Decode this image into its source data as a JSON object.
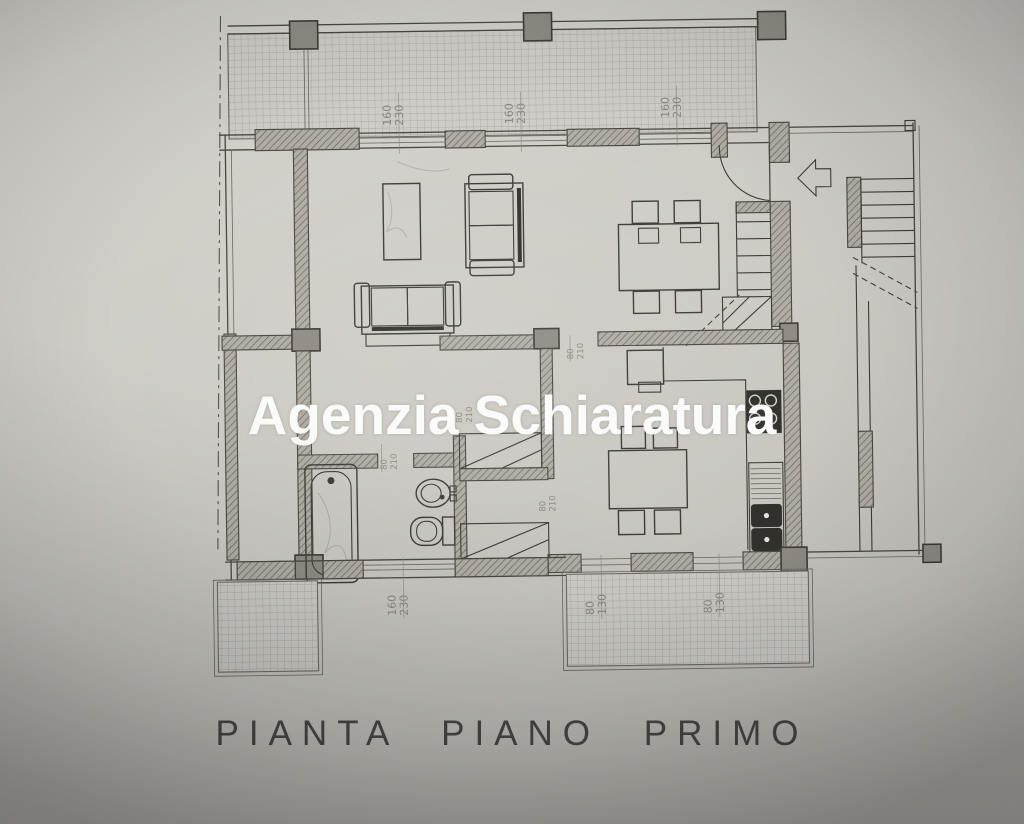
{
  "photo": {
    "watermark": "Agenzia Schiaratura",
    "caption": "PIANTA PIANO PRIMO"
  },
  "dimensions": {
    "window_large": {
      "width": "160",
      "height": "230"
    },
    "window_small": {
      "width": "80",
      "height": "130"
    },
    "door": {
      "width": "80",
      "height": "210"
    }
  },
  "colors": {
    "paper": "#cfccc6",
    "ink": "#45423c",
    "wall_fill": "#aeaaa3",
    "dimension_text": "#8d887f",
    "watermark_text": "#fbfbf9",
    "caption_text": "#3b3935"
  }
}
